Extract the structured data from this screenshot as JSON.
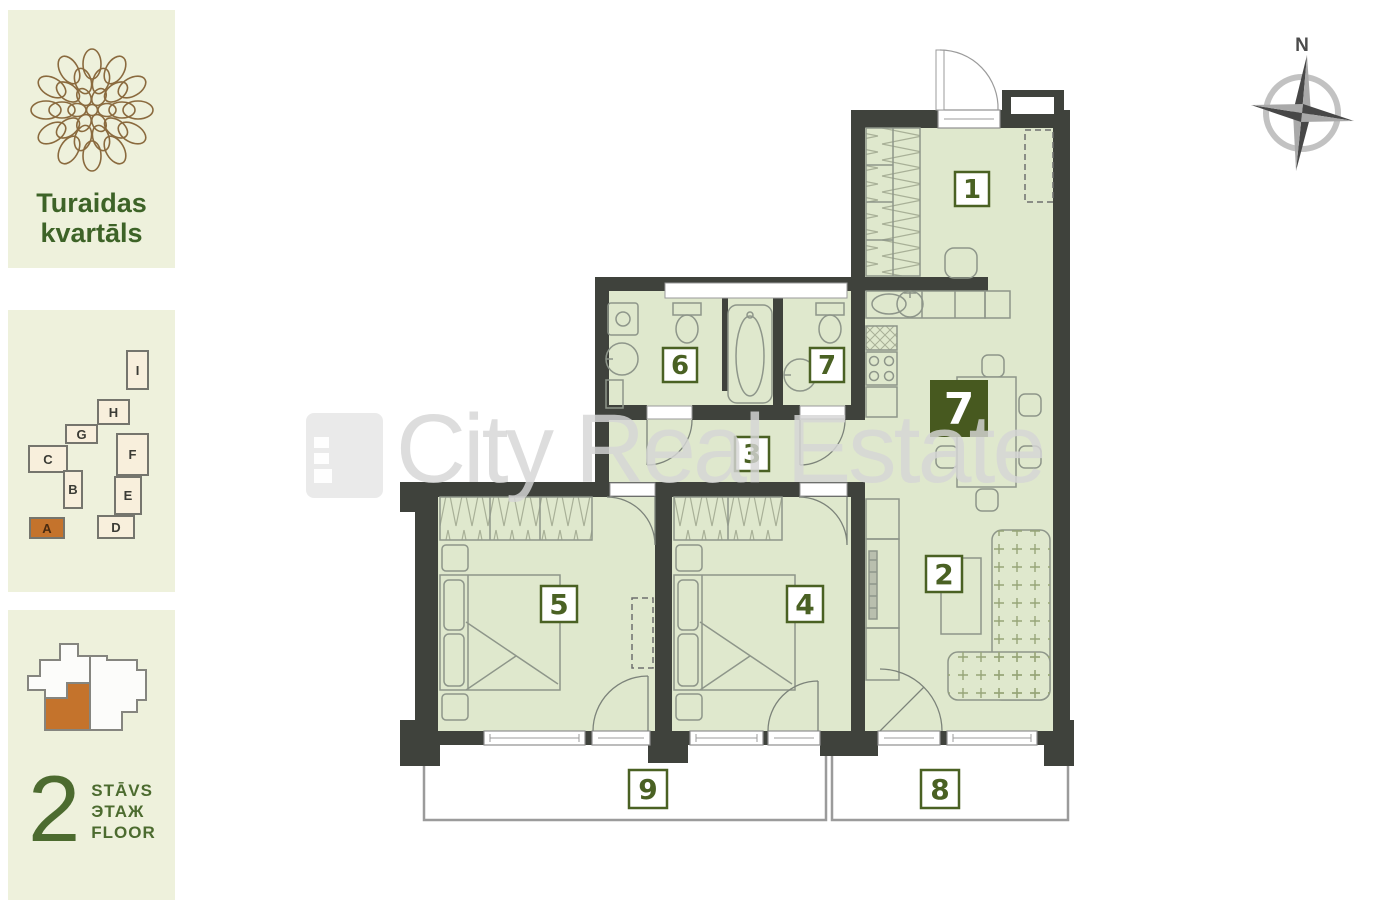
{
  "brand": {
    "line1": "Turaidas",
    "line2": "kvartāls"
  },
  "site_plan": {
    "blocks": [
      {
        "label": "I"
      },
      {
        "label": "H"
      },
      {
        "label": "G"
      },
      {
        "label": "C"
      },
      {
        "label": "B"
      },
      {
        "label": "F"
      },
      {
        "label": "E"
      },
      {
        "label": "D"
      },
      {
        "label": "A"
      }
    ],
    "highlighted_block": "A"
  },
  "floor_indicator": {
    "number": "2",
    "labels": [
      "STĀVS",
      "ЭТАЖ",
      "FLOOR"
    ]
  },
  "floor_plan": {
    "compass": "N",
    "apartment_badge": "7",
    "room_labels": {
      "r1": "1",
      "r2": "2",
      "r3": "3",
      "r4": "4",
      "r5": "5",
      "r6": "6",
      "r7": "7",
      "r8": "8",
      "r9": "9"
    }
  },
  "watermark": {
    "text": "City Real Estate"
  },
  "colors": {
    "accent_orange": "#c4732c",
    "label_green": "#4a6123",
    "wall": "#3f423c",
    "room_fill": "#dfe8cd",
    "badge_green": "#47591f",
    "panel_bg": "#eef1dc",
    "block_cream": "#f8efdc",
    "brand_green": "#3d6327"
  }
}
